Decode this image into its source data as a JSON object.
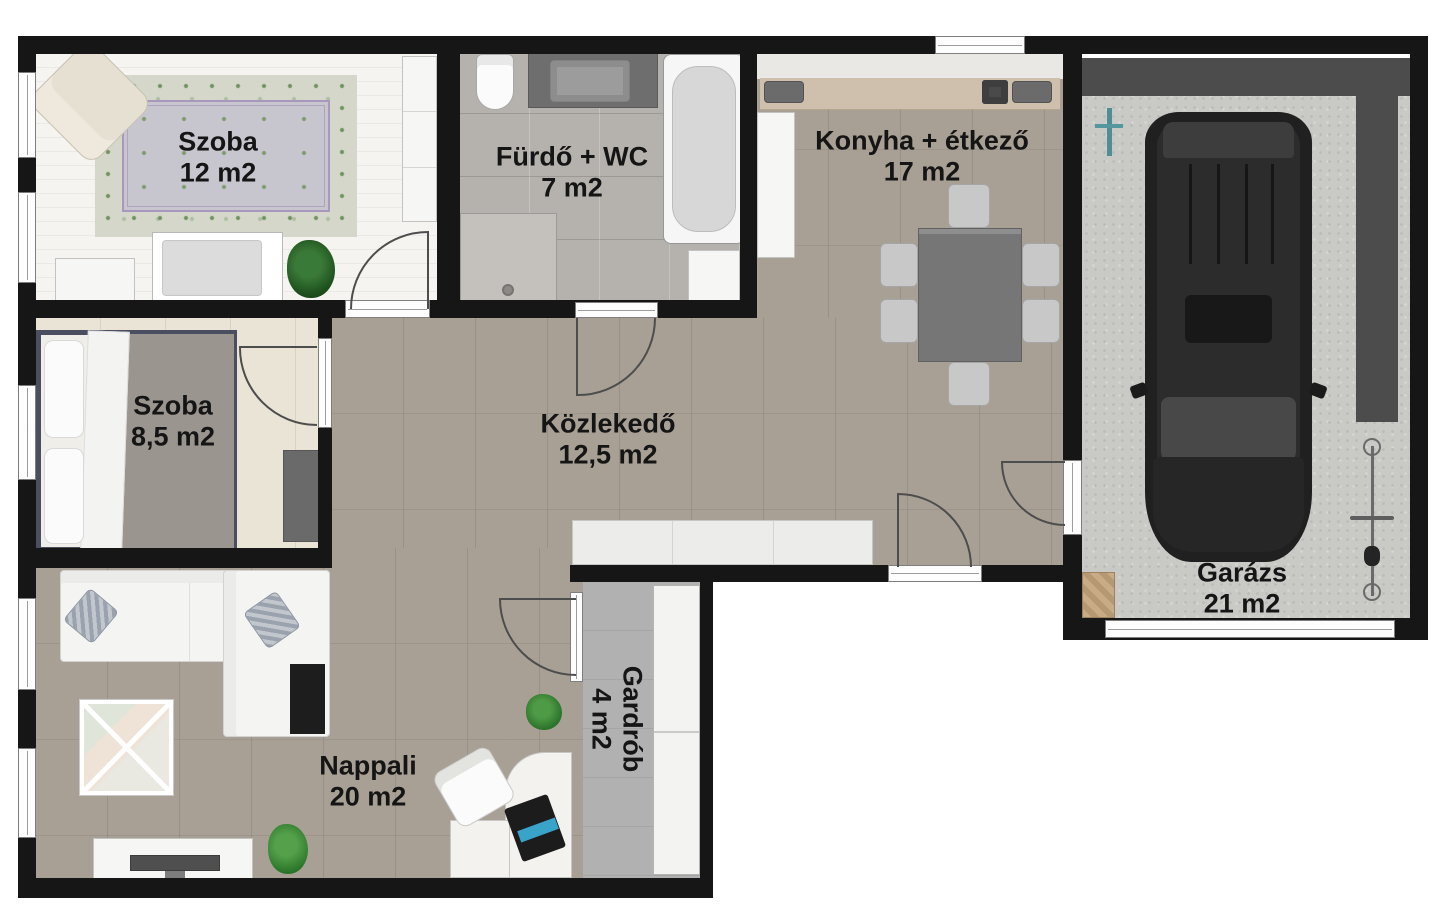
{
  "title": "Apartment floor plan",
  "rooms": {
    "szoba12": {
      "name": "Szoba",
      "area": "12 m2"
    },
    "furdo": {
      "name": "Fürdő + WC",
      "area": "7 m2"
    },
    "konyha": {
      "name": "Konyha + étkező",
      "area": "17 m2"
    },
    "szoba85": {
      "name": "Szoba",
      "area": "8,5 m2"
    },
    "kozlekedo": {
      "name": "Közlekedő",
      "area": "12,5 m2"
    },
    "nappali": {
      "name": "Nappali",
      "area": "20 m2"
    },
    "gardrob": {
      "name": "Gardrób",
      "area": "4 m2"
    },
    "garazs": {
      "name": "Garázs",
      "area": "21 m2"
    }
  },
  "palette": {
    "wall": "#161616",
    "floor_hall_kitchen_living": "#a8a095",
    "floor_bathroom": "#b5b2ad",
    "floor_bedroom_large": "#f5f4f1",
    "floor_bedroom_small": "#eae4d7",
    "floor_wardrobe": "#b1b1b1",
    "floor_garage": "#c9c9c6",
    "kitchen_counter": "#cfc0ae",
    "garage_shelf": "#4c4c4c",
    "plant_green": "#2e6b2e",
    "label_text": "#151515"
  }
}
